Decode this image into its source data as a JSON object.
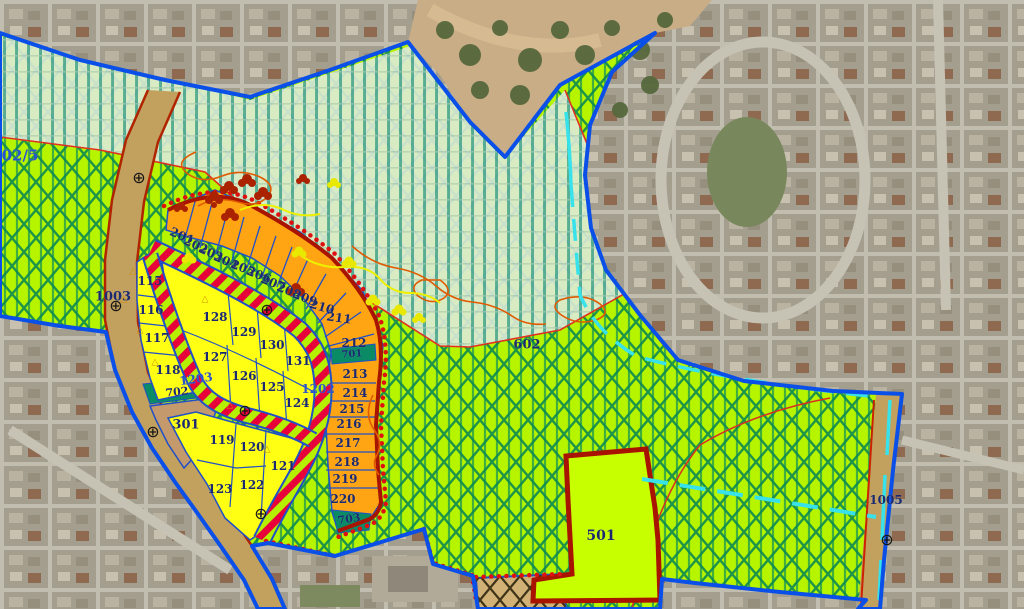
{
  "map_type": "municipal zoning plan overlaid on aerial imagery",
  "colors": {
    "parcel_number": "#1b2a70",
    "road_number": "#2a52cc",
    "zone_green": "#b6f400",
    "zone_light_band": "#dcead9",
    "orange_parcel": "#ffa513",
    "yellow_parcel": "#ffff14",
    "striped_road_red": "#e8003a",
    "teal_strip": "#0b8a66",
    "brown_parcel": "#c49a6c",
    "road_tan": "#c2a05e",
    "parcel_501_green": "#c8ff00",
    "boundary_blue": "#0a50e8",
    "boundary_dark_red": "#a81400",
    "dotted_boundary_red": "#e01010",
    "cyan_line": "#38e2ea"
  },
  "icons": {
    "survey_marker": "circle-with-cross",
    "triangle_marker": "hollow-triangle",
    "tree_symbol": "leaf-cluster"
  },
  "labels": [
    {
      "t": "02/5",
      "x": 20,
      "y": 156,
      "s": 15,
      "c": "road_number",
      "r": 0
    },
    {
      "t": "1003",
      "x": 113,
      "y": 297,
      "s": 13,
      "c": "parcel_number",
      "r": 0
    },
    {
      "t": "1005",
      "x": 886,
      "y": 500,
      "s": 12,
      "c": "parcel_number",
      "r": 0
    },
    {
      "t": "1202",
      "x": 318,
      "y": 389,
      "s": 12,
      "c": "road_number",
      "r": 0
    },
    {
      "t": "1203",
      "x": 196,
      "y": 379,
      "s": 12,
      "c": "road_number",
      "r": -8
    },
    {
      "t": "602",
      "x": 527,
      "y": 345,
      "s": 13,
      "c": "parcel_number",
      "r": 0
    },
    {
      "t": "501",
      "x": 601,
      "y": 536,
      "s": 14,
      "c": "parcel_number",
      "r": 0
    },
    {
      "t": "301",
      "x": 186,
      "y": 425,
      "s": 13,
      "c": "parcel_number",
      "r": 0
    },
    {
      "t": "701",
      "x": 352,
      "y": 355,
      "s": 10,
      "c": "parcel_number",
      "r": -4
    },
    {
      "t": "702",
      "x": 177,
      "y": 392,
      "s": 11,
      "c": "parcel_number",
      "r": -6
    },
    {
      "t": "703",
      "x": 349,
      "y": 519,
      "s": 11,
      "c": "parcel_number",
      "r": -8
    },
    {
      "t": "201",
      "x": 182,
      "y": 236,
      "s": 12,
      "c": "parcel_number",
      "r": 24
    },
    {
      "t": "202",
      "x": 196,
      "y": 245,
      "s": 12,
      "c": "parcel_number",
      "r": 24
    },
    {
      "t": "203",
      "x": 211,
      "y": 253,
      "s": 12,
      "c": "parcel_number",
      "r": 24
    },
    {
      "t": "204",
      "x": 226,
      "y": 261,
      "s": 12,
      "c": "parcel_number",
      "r": 24
    },
    {
      "t": "205",
      "x": 243,
      "y": 268,
      "s": 12,
      "c": "parcel_number",
      "r": 22
    },
    {
      "t": "206",
      "x": 259,
      "y": 275,
      "s": 12,
      "c": "parcel_number",
      "r": 22
    },
    {
      "t": "207",
      "x": 273,
      "y": 283,
      "s": 12,
      "c": "parcel_number",
      "r": 22
    },
    {
      "t": "208",
      "x": 289,
      "y": 291,
      "s": 12,
      "c": "parcel_number",
      "r": 22
    },
    {
      "t": "209",
      "x": 305,
      "y": 298,
      "s": 12,
      "c": "parcel_number",
      "r": 22
    },
    {
      "t": "210",
      "x": 322,
      "y": 307,
      "s": 12,
      "c": "parcel_number",
      "r": 16
    },
    {
      "t": "211",
      "x": 339,
      "y": 318,
      "s": 12,
      "c": "parcel_number",
      "r": 8
    },
    {
      "t": "212",
      "x": 354,
      "y": 343,
      "s": 12,
      "c": "parcel_number",
      "r": 0
    },
    {
      "t": "213",
      "x": 355,
      "y": 374,
      "s": 12,
      "c": "parcel_number",
      "r": 0
    },
    {
      "t": "214",
      "x": 355,
      "y": 393,
      "s": 12,
      "c": "parcel_number",
      "r": 0
    },
    {
      "t": "215",
      "x": 352,
      "y": 409,
      "s": 12,
      "c": "parcel_number",
      "r": 0
    },
    {
      "t": "216",
      "x": 349,
      "y": 424,
      "s": 12,
      "c": "parcel_number",
      "r": 0
    },
    {
      "t": "217",
      "x": 348,
      "y": 443,
      "s": 12,
      "c": "parcel_number",
      "r": 0
    },
    {
      "t": "218",
      "x": 347,
      "y": 462,
      "s": 12,
      "c": "parcel_number",
      "r": 0
    },
    {
      "t": "219",
      "x": 345,
      "y": 479,
      "s": 12,
      "c": "parcel_number",
      "r": 0
    },
    {
      "t": "220",
      "x": 343,
      "y": 499,
      "s": 12,
      "c": "parcel_number",
      "r": 0
    },
    {
      "t": "115",
      "x": 150,
      "y": 281,
      "s": 12,
      "c": "parcel_number",
      "r": 0
    },
    {
      "t": "116",
      "x": 151,
      "y": 310,
      "s": 12,
      "c": "parcel_number",
      "r": 0
    },
    {
      "t": "117",
      "x": 157,
      "y": 338,
      "s": 12,
      "c": "parcel_number",
      "r": 0
    },
    {
      "t": "118",
      "x": 168,
      "y": 370,
      "s": 12,
      "c": "parcel_number",
      "r": 0
    },
    {
      "t": "128",
      "x": 215,
      "y": 317,
      "s": 12,
      "c": "parcel_number",
      "r": 0
    },
    {
      "t": "129",
      "x": 244,
      "y": 332,
      "s": 12,
      "c": "parcel_number",
      "r": 0
    },
    {
      "t": "130",
      "x": 272,
      "y": 345,
      "s": 12,
      "c": "parcel_number",
      "r": 0
    },
    {
      "t": "131",
      "x": 298,
      "y": 361,
      "s": 12,
      "c": "parcel_number",
      "r": 0
    },
    {
      "t": "127",
      "x": 215,
      "y": 357,
      "s": 12,
      "c": "parcel_number",
      "r": 0
    },
    {
      "t": "126",
      "x": 244,
      "y": 376,
      "s": 12,
      "c": "parcel_number",
      "r": 0
    },
    {
      "t": "125",
      "x": 272,
      "y": 387,
      "s": 12,
      "c": "parcel_number",
      "r": 0
    },
    {
      "t": "124",
      "x": 297,
      "y": 403,
      "s": 12,
      "c": "parcel_number",
      "r": 0
    },
    {
      "t": "119",
      "x": 222,
      "y": 440,
      "s": 12,
      "c": "parcel_number",
      "r": 0
    },
    {
      "t": "120",
      "x": 252,
      "y": 447,
      "s": 12,
      "c": "parcel_number",
      "r": 0
    },
    {
      "t": "121",
      "x": 283,
      "y": 466,
      "s": 12,
      "c": "parcel_number",
      "r": 0
    },
    {
      "t": "122",
      "x": 252,
      "y": 485,
      "s": 12,
      "c": "parcel_number",
      "r": 0
    },
    {
      "t": "123",
      "x": 220,
      "y": 489,
      "s": 12,
      "c": "parcel_number",
      "r": 0
    }
  ],
  "markers": {
    "survey": [
      [
        139,
        178
      ],
      [
        116,
        306
      ],
      [
        153,
        432
      ],
      [
        245,
        411
      ],
      [
        267,
        310
      ],
      [
        261,
        514
      ],
      [
        887,
        540
      ]
    ],
    "triangles": [
      [
        133,
        272
      ],
      [
        124,
        300
      ],
      [
        140,
        331
      ],
      [
        155,
        363
      ],
      [
        230,
        406
      ],
      [
        267,
        450
      ],
      [
        205,
        300
      ]
    ]
  }
}
